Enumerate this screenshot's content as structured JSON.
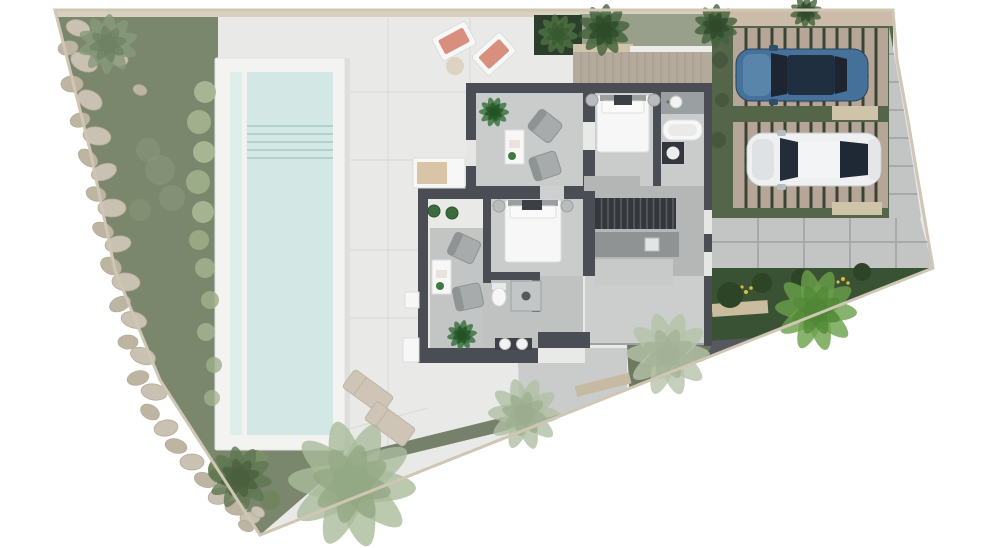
{
  "meta": {
    "title": "Villa site plan – rendered top view",
    "description": "Architectural top-view render of a villa plot with pool, garden, terrace, interior furniture layout and two parked cars",
    "canvas": {
      "width": 1000,
      "height": 548
    }
  },
  "palette": {
    "page_bg": "#ffffff",
    "terrace": "#e9eae8",
    "garden": "#7b876c",
    "gravel": "#d9d1bf",
    "gravel2": "#cbbba8",
    "edge_gravel": "#cfc6b4",
    "pool_coping": "#f3f4f2",
    "pool_water": "#d3e8e5",
    "pool_lane": "#ddeeeb",
    "wall": "#4a4e54",
    "floor_light": "#c9cccb",
    "floor_mid": "#b4b7b6",
    "floor_entry": "#cbcecd",
    "floor_lounge2": "#c2c5c4",
    "stairs": "#34383c",
    "deck_wood": "#b3aa9c",
    "moss_band": "#98a08c",
    "parking_grass": "#55654a",
    "deck_pad": "#b5a698",
    "pad_joint": "#3a4334",
    "concrete": "#c3c5c4",
    "patio": "#cacccb",
    "planting_dark": "#3a5234",
    "wedge_green": "#6e7a60",
    "strip_green": "#75816a",
    "rock": "#c9c1b1",
    "rock_alt": "#bdb4a2",
    "car_blue": "#45719a",
    "car_white": "#eef0f1",
    "glass_dark": "#1d2530",
    "lounger_salmon": "#d98f7e",
    "lounger_beige": "#cfc5b6",
    "flower_yellow": "#d9bb40"
  },
  "scene": {
    "objects": [
      "plot-boundary",
      "rock-garden",
      "lap-pool",
      "sun-terrace",
      "villa-floorplan",
      "bedroom-1",
      "bedroom-2",
      "lounge-1",
      "lounge-2",
      "bathroom-1",
      "bathroom-2",
      "kitchen",
      "staircase",
      "entry-hall",
      "wood-deck",
      "parking-court",
      "blue-suv",
      "white-car",
      "driveway-slabs",
      "planting-bed",
      "palm-trees"
    ],
    "rocks": [
      [
        78,
        28,
        12,
        8,
        15
      ],
      [
        68,
        48,
        10,
        7,
        -10
      ],
      [
        84,
        62,
        14,
        9,
        25
      ],
      [
        72,
        84,
        11,
        8,
        0
      ],
      [
        90,
        100,
        13,
        9,
        30
      ],
      [
        80,
        120,
        10,
        7,
        -15
      ],
      [
        97,
        136,
        14,
        9,
        10
      ],
      [
        88,
        158,
        11,
        7,
        40
      ],
      [
        104,
        172,
        13,
        8,
        -20
      ],
      [
        96,
        194,
        10,
        7,
        15
      ],
      [
        112,
        208,
        14,
        9,
        0
      ],
      [
        103,
        230,
        11,
        7,
        25
      ],
      [
        118,
        244,
        13,
        8,
        -10
      ],
      [
        111,
        266,
        11,
        8,
        30
      ],
      [
        126,
        282,
        14,
        9,
        5
      ],
      [
        120,
        304,
        11,
        7,
        -25
      ],
      [
        134,
        320,
        13,
        8,
        15
      ],
      [
        128,
        342,
        10,
        7,
        0
      ],
      [
        143,
        356,
        13,
        8,
        20
      ],
      [
        138,
        378,
        11,
        7,
        -15
      ],
      [
        154,
        392,
        13,
        8,
        10
      ],
      [
        150,
        412,
        10,
        7,
        30
      ],
      [
        166,
        428,
        12,
        8,
        -10
      ],
      [
        176,
        446,
        11,
        7,
        15
      ],
      [
        192,
        462,
        12,
        8,
        0
      ],
      [
        205,
        480,
        11,
        7,
        20
      ],
      [
        220,
        496,
        12,
        8,
        -15
      ],
      [
        236,
        508,
        11,
        7,
        10
      ],
      [
        250,
        518,
        10,
        6,
        0
      ],
      [
        246,
        526,
        8,
        5,
        25
      ],
      [
        120,
        60,
        8,
        6,
        0
      ],
      [
        140,
        90,
        7,
        5,
        20
      ],
      [
        258,
        512,
        7,
        5,
        30
      ]
    ],
    "shrubs": [
      [
        205,
        92,
        11,
        "#aab795",
        0.95
      ],
      [
        199,
        122,
        12,
        "#a3b18e",
        0.95
      ],
      [
        204,
        152,
        11,
        "#aab795",
        0.95
      ],
      [
        198,
        182,
        12,
        "#9fae8a",
        0.95
      ],
      [
        203,
        212,
        11,
        "#a8b593",
        0.95
      ],
      [
        199,
        240,
        10,
        "#9cab86",
        0.9
      ],
      [
        205,
        268,
        10,
        "#a3b18e",
        0.85
      ],
      [
        210,
        300,
        9,
        "#9fae8a",
        0.85
      ],
      [
        206,
        332,
        9,
        "#a8b593",
        0.8
      ],
      [
        214,
        365,
        8,
        "#9fae8a",
        0.8
      ],
      [
        212,
        398,
        8,
        "#a3b18e",
        0.75
      ],
      [
        160,
        170,
        15,
        "#8b9a7e",
        0.5
      ],
      [
        148,
        150,
        12,
        "#8b9a7e",
        0.45
      ],
      [
        172,
        198,
        13,
        "#8b9a7e",
        0.5
      ],
      [
        140,
        210,
        11,
        "#8b9a7e",
        0.4
      ],
      [
        222,
        470,
        14,
        "#6f855c",
        1
      ],
      [
        256,
        462,
        12,
        "#7b8f66",
        1
      ],
      [
        270,
        500,
        10,
        "#6f855c",
        0.9
      ],
      [
        720,
        60,
        8,
        "#44553c",
        0.9
      ],
      [
        722,
        100,
        7,
        "#44553c",
        0.8
      ],
      [
        718,
        140,
        8,
        "#44553c",
        0.85
      ],
      [
        730,
        295,
        13,
        "#2d4427",
        1
      ],
      [
        762,
        283,
        10,
        "#2d4427",
        1
      ],
      [
        800,
        278,
        9,
        "#2d4427",
        1
      ],
      [
        862,
        272,
        9,
        "#2d4427",
        1
      ]
    ],
    "trees": [
      {
        "x": 352,
        "y": 484,
        "r": 64,
        "color": "#a9bb9b",
        "core": "#93a884",
        "name": "palm-large"
      },
      {
        "x": 524,
        "y": 414,
        "r": 36,
        "color": "#b0c0a4",
        "core": "#9cad8f",
        "name": "tree-pale-terrace"
      },
      {
        "x": 668,
        "y": 354,
        "r": 42,
        "color": "#b6c3aa",
        "core": "#a3b296",
        "name": "tree-pale-patio"
      },
      {
        "x": 816,
        "y": 310,
        "r": 41,
        "color": "#6aa04b",
        "core": "#4f8736",
        "name": "tree-bright-bed"
      },
      {
        "x": 604,
        "y": 30,
        "r": 26,
        "color": "#3f6038",
        "core": "#2e4b29",
        "name": "palm-top-1"
      },
      {
        "x": 716,
        "y": 26,
        "r": 22,
        "color": "#42603a",
        "core": "#30492b",
        "name": "palm-top-2"
      },
      {
        "x": 806,
        "y": 12,
        "r": 16,
        "color": "#42603a",
        "core": "#30492b",
        "name": "palm-top-3"
      },
      {
        "x": 108,
        "y": 44,
        "r": 30,
        "color": "#87997b",
        "core": "#6f8263",
        "name": "garden-bush"
      },
      {
        "x": 240,
        "y": 478,
        "r": 32,
        "color": "#5f7752",
        "core": "#49603e",
        "name": "garden-bush-low"
      },
      {
        "x": 558,
        "y": 34,
        "r": 20,
        "color": "#4f7243",
        "core": "#3a5830",
        "name": "planter-palm"
      },
      {
        "x": 494,
        "y": 112,
        "r": 15,
        "color": "#347038",
        "core": "#235426",
        "name": "indoor-plant-1"
      },
      {
        "x": 462,
        "y": 335,
        "r": 15,
        "color": "#347038",
        "core": "#235426",
        "name": "indoor-plant-2"
      }
    ],
    "parking_pads": [
      {
        "x": 733,
        "y": 28,
        "w": 155,
        "h": 78,
        "step": 13
      },
      {
        "x": 733,
        "y": 122,
        "w": 155,
        "h": 86,
        "step": 13
      }
    ],
    "stairs": {
      "x": 595,
      "y": 198,
      "w": 81,
      "h": 31,
      "step": 6.5
    }
  }
}
